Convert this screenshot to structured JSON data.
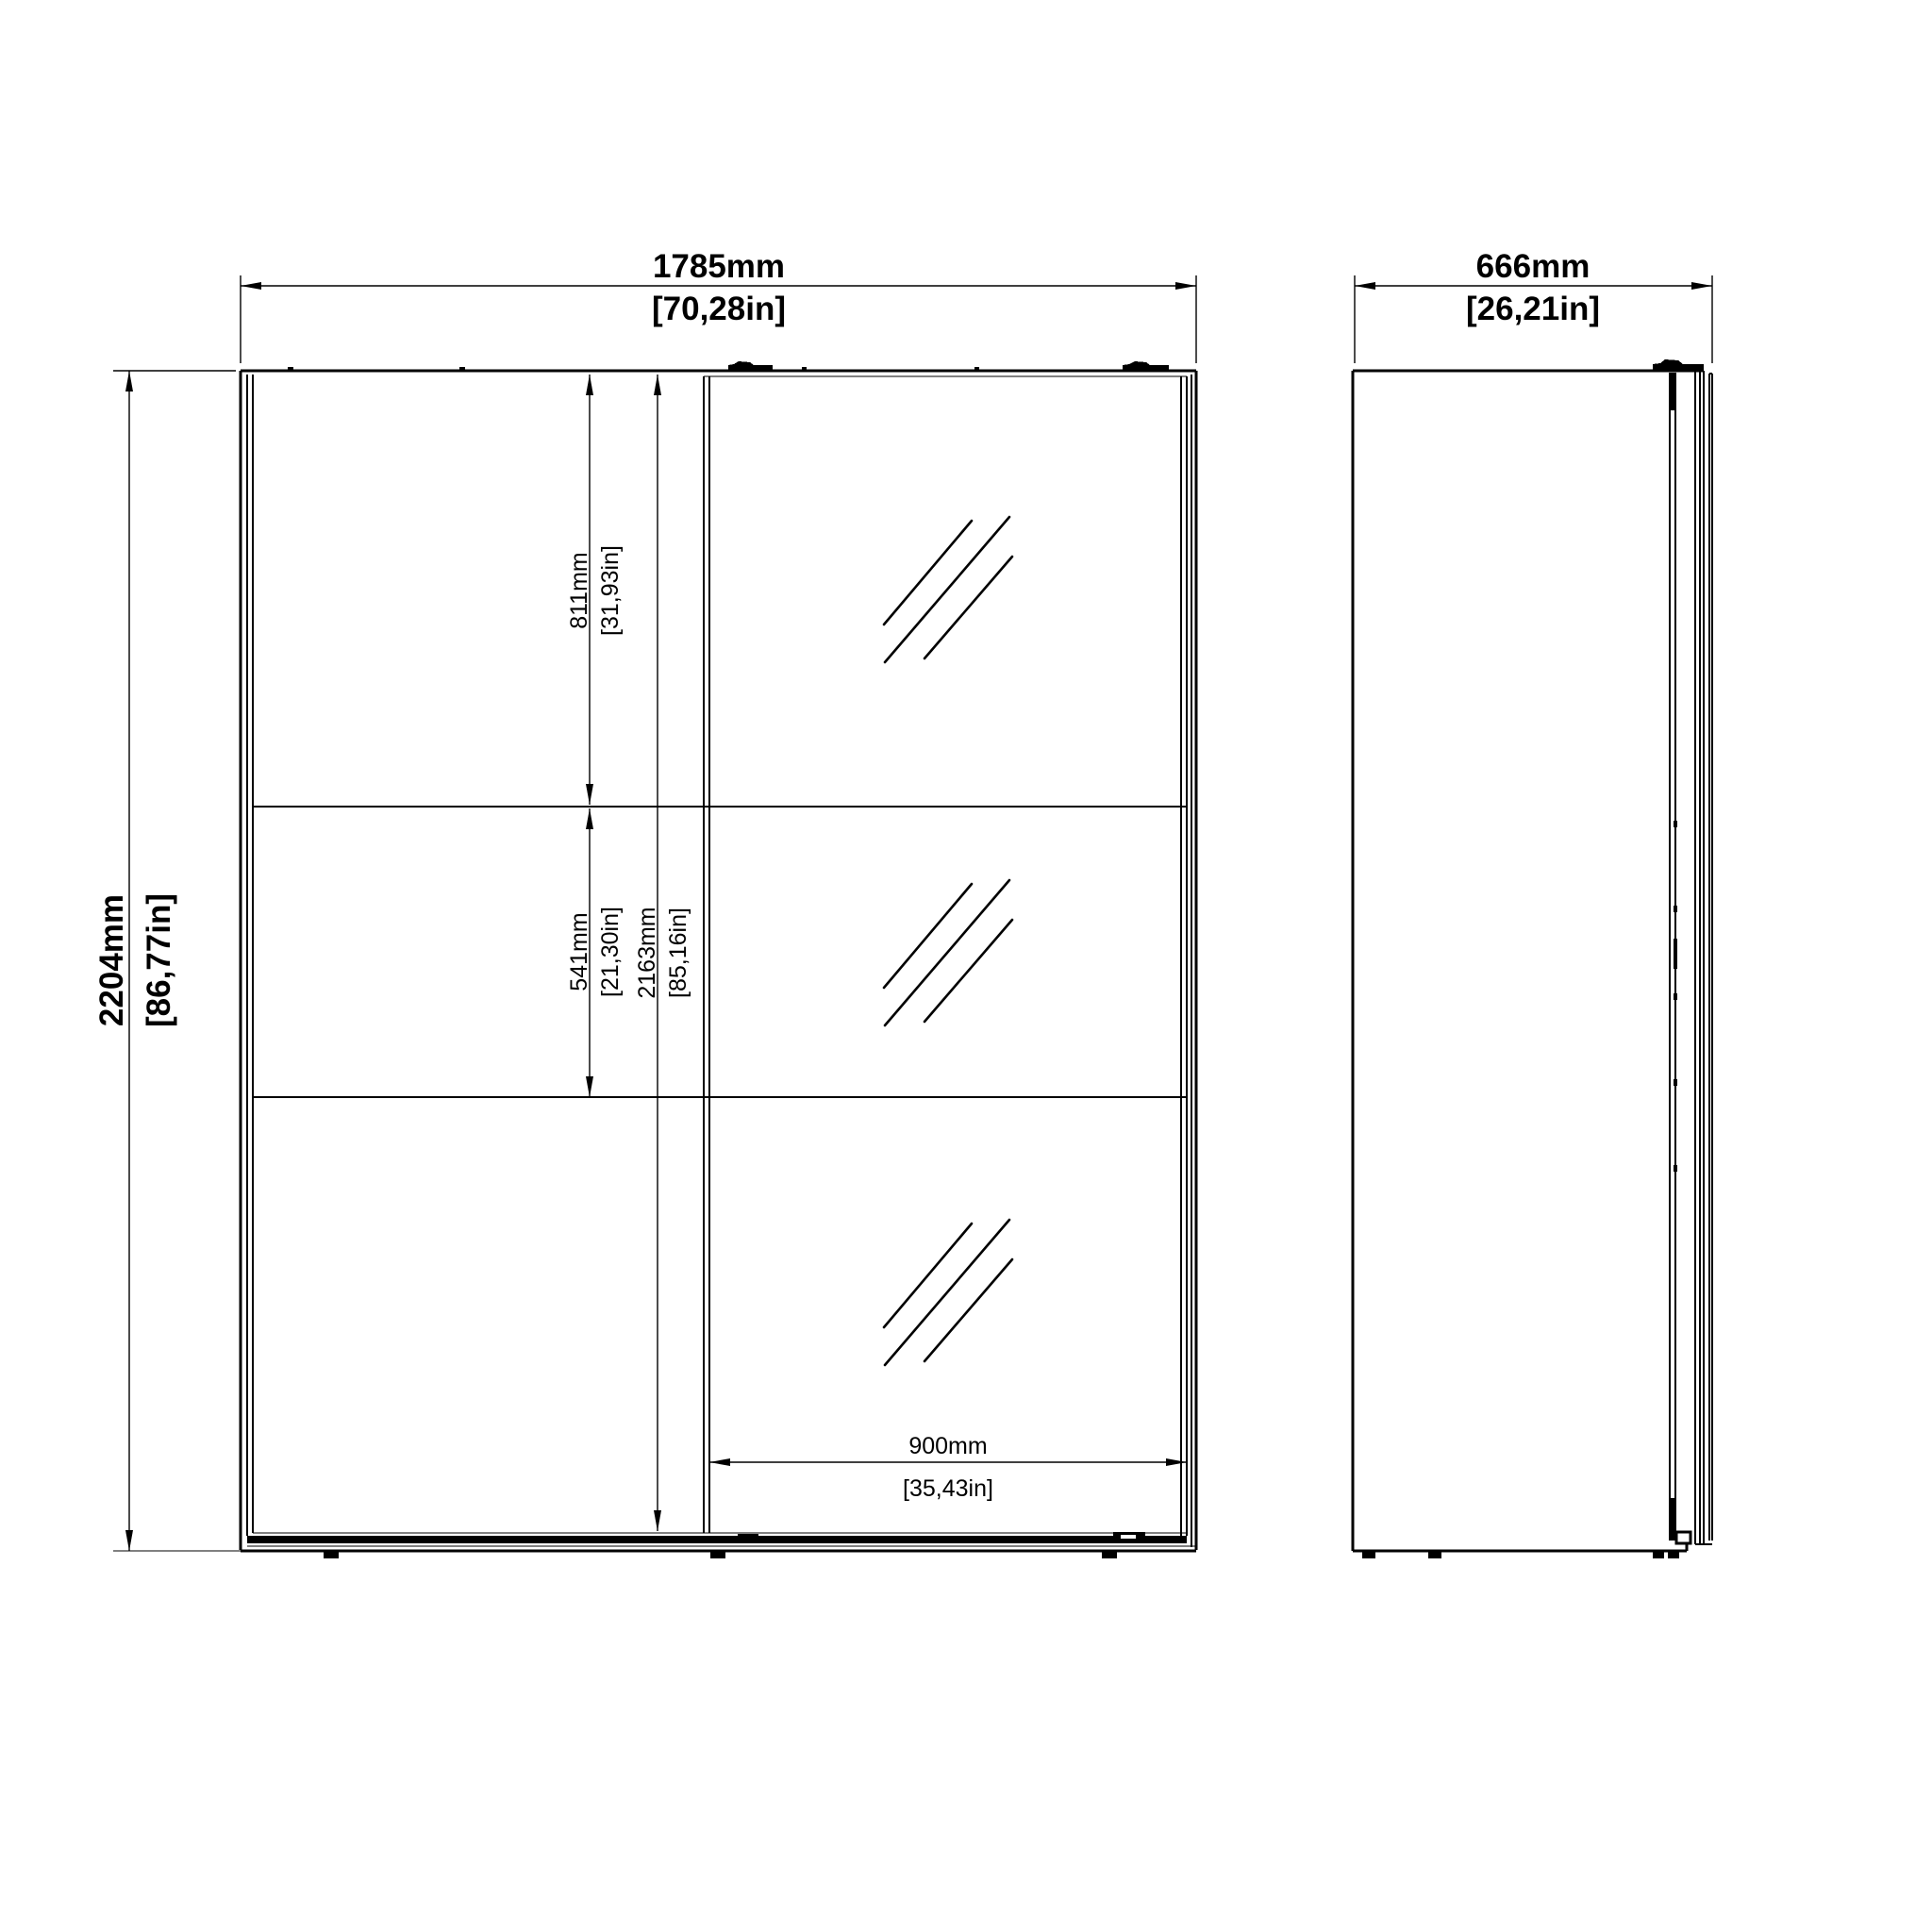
{
  "drawing": {
    "views": {
      "front": {
        "width": {
          "mm": "1785mm",
          "inch": "[70,28in]"
        },
        "height": {
          "mm": "2204mm",
          "inch": "[86,77in]"
        },
        "top_section": {
          "mm": "811mm",
          "inch": "[31,93in]"
        },
        "middle_section": {
          "mm": "541mm",
          "inch": "[21,30in]"
        },
        "interior_height": {
          "mm": "2163mm",
          "inch": "[85,16in]"
        },
        "mirror_door_width": {
          "mm": "900mm",
          "inch": "[35,43in]"
        }
      },
      "side": {
        "depth": {
          "mm": "666mm",
          "inch": "[26,21in]"
        }
      }
    },
    "line_color": "#000000",
    "background_color": "#ffffff"
  }
}
